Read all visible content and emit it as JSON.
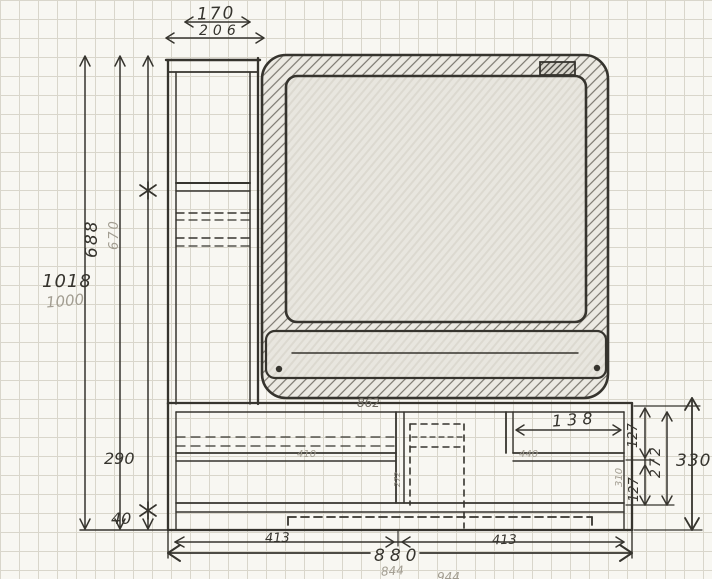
{
  "palette": {
    "paper": "#f8f7f2",
    "grid": "#d9d6cb",
    "ink": "#36342e",
    "pencil": "#a29d91"
  },
  "dimensions": {
    "top_inner_width": "170",
    "top_outer_width": "206",
    "total_height": "1018",
    "total_height_pencil": "1000",
    "upper_height": "688",
    "upper_height_pencil": "670",
    "base_height": "290",
    "plinth_height": "40",
    "base_inner_width": "862",
    "left_shelf_pencil": "410",
    "right_shelf_pencil": "440",
    "right_bay_width": "138",
    "right_seg_top": "127",
    "right_seg_mid": "272",
    "right_seg_bottom": "127",
    "right_total": "330",
    "side_edge_pencil": "310",
    "divider_pencil": "272",
    "bottom_left_bay": "413",
    "bottom_right_bay": "413",
    "total_width": "880",
    "total_width_pencil": "844",
    "total_width_pencil_2": "944"
  }
}
